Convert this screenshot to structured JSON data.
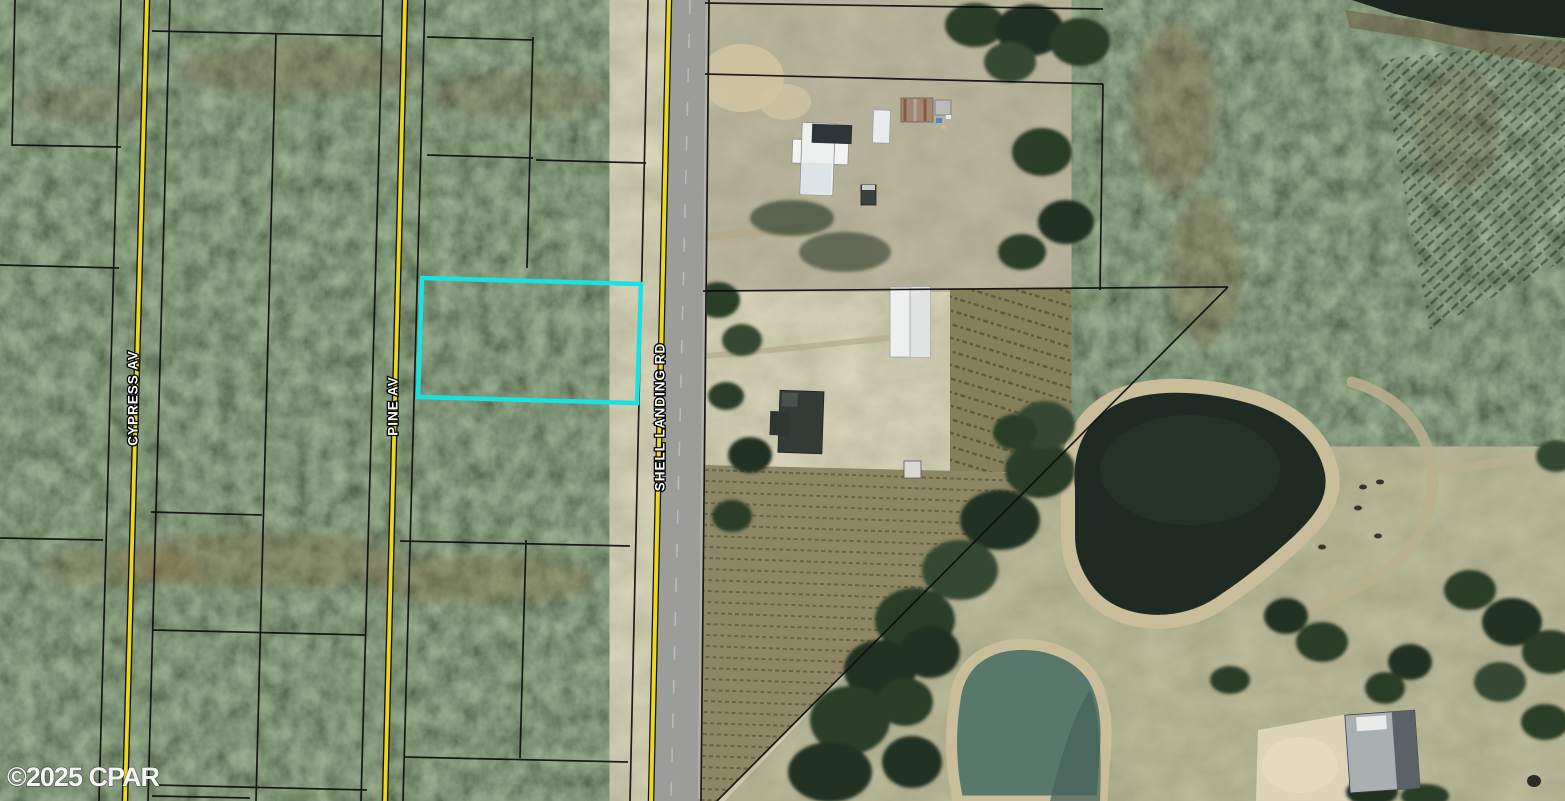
{
  "map": {
    "type": "aerial-parcel-map",
    "watermark": "©2025 CPAR",
    "roads": [
      {
        "id": "cypress-av",
        "label": "CYPRESS AV"
      },
      {
        "id": "pine-av",
        "label": "PINE AV"
      },
      {
        "id": "shell-landing-rd",
        "label": "SHELL LANDING RD"
      }
    ],
    "highlighted_parcel": {
      "outline_color": "#19e2e2",
      "shape": "rectangle",
      "location": "west of Shell Landing Rd, east of Pine Av"
    },
    "colors": {
      "road_centerline_yellow": "#e9d722",
      "pavement_gray": "#9c9c98",
      "parcel_line": "#0d0d0d",
      "label_fill": "#ffffff",
      "label_halo": "#000000",
      "pond_dark_water": "#1f2b22",
      "pond_teal_water": "#57786a",
      "sand": "#ddd3b8",
      "forest_green": "#2d3a29",
      "pasture_olive": "#8e8f6f"
    }
  }
}
